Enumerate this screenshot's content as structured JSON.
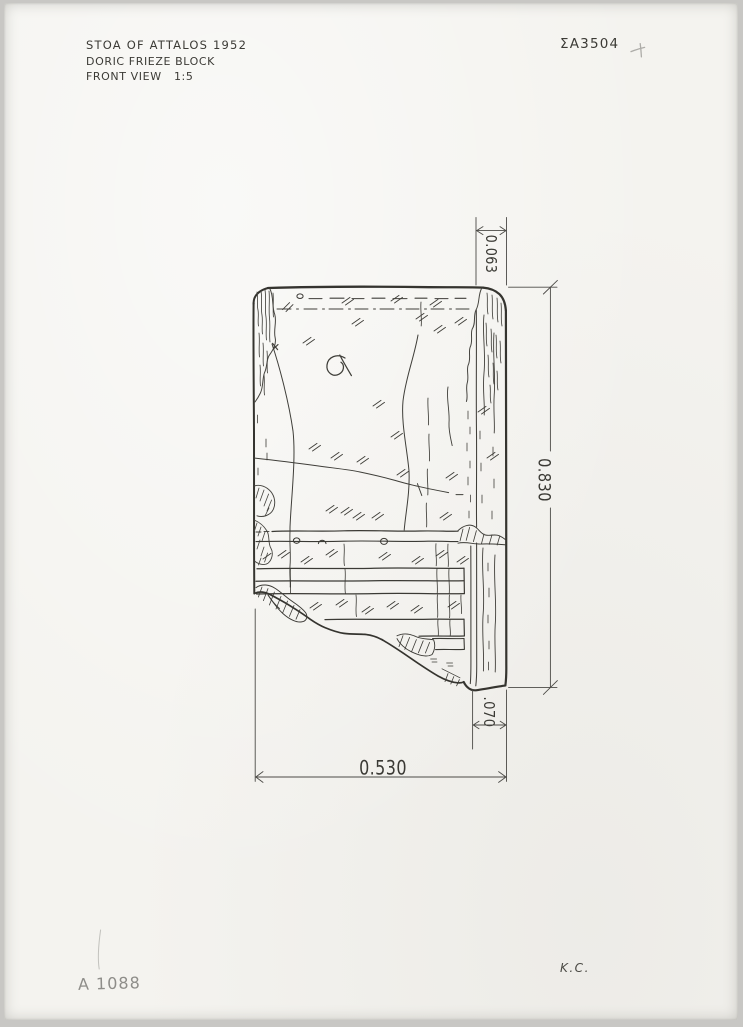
{
  "sheet": {
    "title_block": {
      "line1": "STOA OF ATTALOS 1952",
      "line2": "DORIC FRIEZE BLOCK",
      "line3": "FRONT VIEW   1:5"
    },
    "catalog_number": "ΣΑ3504",
    "inventory_number": "A 1088",
    "initials": "K.C.",
    "dimensions": {
      "top_width": "0.063",
      "height": "0.830",
      "bottom_band": ".070",
      "width": "0.530"
    },
    "ink_color": "#3b3a36",
    "pencil_color": "#8e8d89",
    "paper_color": "#f4f3ef"
  }
}
